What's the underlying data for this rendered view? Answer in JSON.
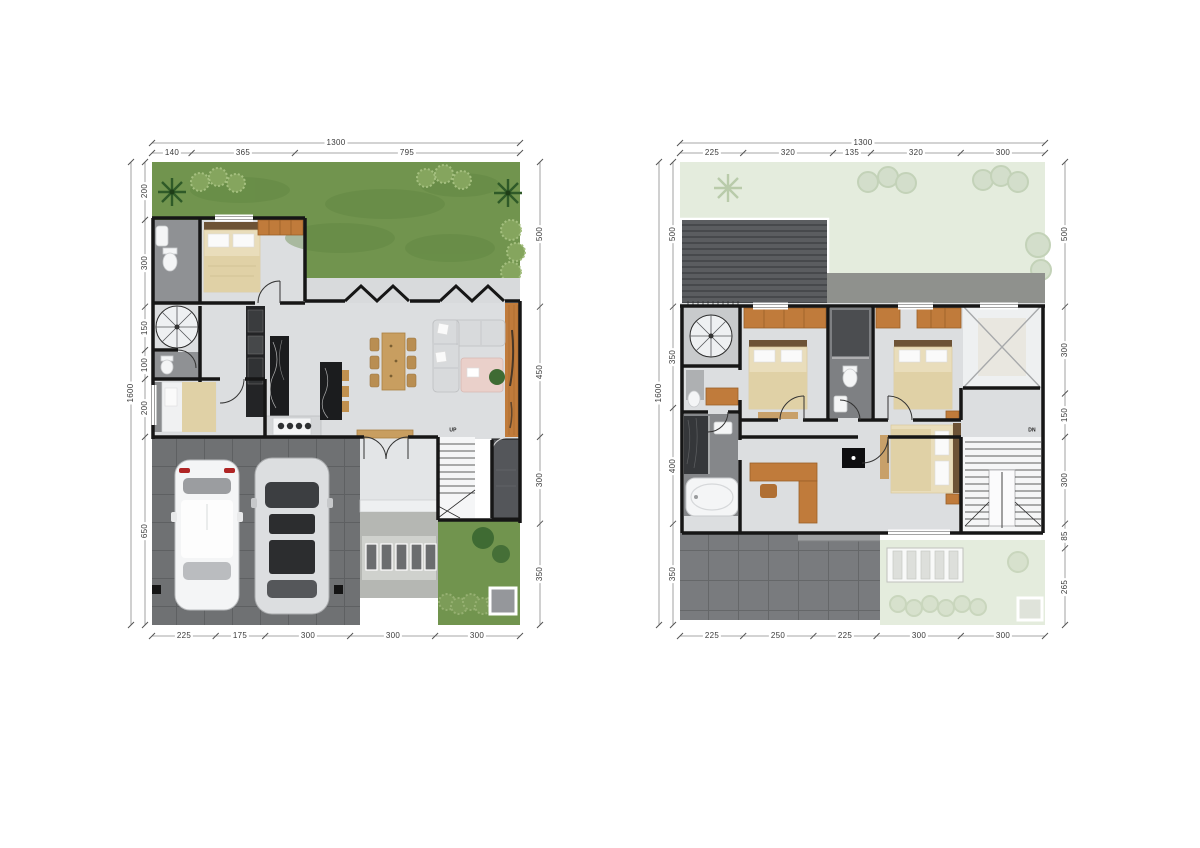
{
  "title": "two-storey house floor plans",
  "colors": {
    "wall": "#161616",
    "dimline": "#8a8a8a",
    "dimtext": "#3a3a3a",
    "grass": "#71944e",
    "pgrass": "#e4ecdd",
    "floor": "#dcdee0",
    "deck": "#c07b3b",
    "wood": "#c89e60",
    "orange": "#c07b3b",
    "drive": "#6f7173",
    "terrace": "#797b7e",
    "roof": "#5b5d60",
    "counter": "#1b1c1e",
    "bed": "#e9ddbb",
    "rug": "#ead0ca",
    "tile": "#8f9194"
  },
  "plans": {
    "ground": {
      "stair_label": "UP",
      "dims": {
        "top_total": "1300",
        "top": [
          "140",
          "365",
          "795"
        ],
        "bottom": [
          "225",
          "175",
          "300",
          "300",
          "300"
        ],
        "left_total": "1600",
        "left": [
          "200",
          "300",
          "150",
          "100",
          "200",
          "650"
        ],
        "right": [
          "500",
          "450",
          "300",
          "350"
        ]
      }
    },
    "upper": {
      "stair_label": "DN",
      "dims": {
        "top_total": "1300",
        "top": [
          "225",
          "320",
          "135",
          "320",
          "300"
        ],
        "bottom": [
          "225",
          "250",
          "225",
          "300",
          "300"
        ],
        "left_total": "1600",
        "left": [
          "500",
          "350",
          "400",
          "350"
        ],
        "right": [
          "500",
          "300",
          "150",
          "300",
          "85",
          "265"
        ]
      }
    }
  }
}
